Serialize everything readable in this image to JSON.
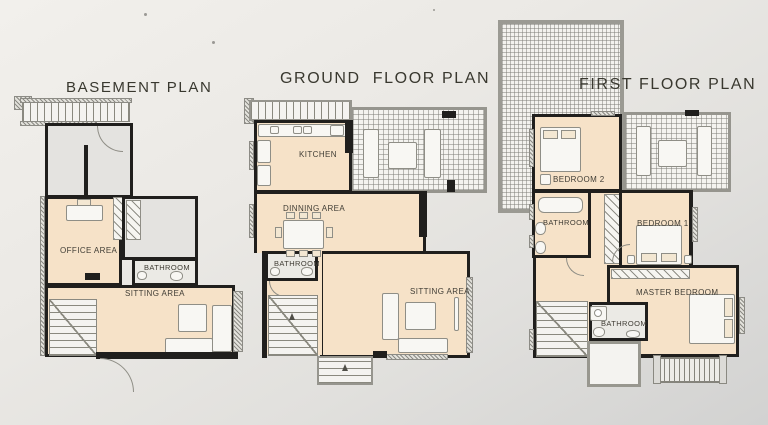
{
  "plans": [
    {
      "id": "basement",
      "title": "BASEMENT PLAN",
      "rooms": [
        {
          "label": "OFFICE AREA"
        },
        {
          "label": "BATHROOM"
        },
        {
          "label": "SITTING AREA"
        }
      ]
    },
    {
      "id": "ground-floor",
      "title": "GROUND  FLOOR PLAN",
      "rooms": [
        {
          "label": "KITCHEN"
        },
        {
          "label": "DINNING AREA"
        },
        {
          "label": "BATHROOM"
        },
        {
          "label": "SITTING AREA"
        }
      ]
    },
    {
      "id": "first-floor",
      "title": "FIRST FLOOR PLAN",
      "rooms": [
        {
          "label": "BEDROOM 2"
        },
        {
          "label": "BATHROOM"
        },
        {
          "label": "BEDROOM 1"
        },
        {
          "label": "MASTER BEDROOM"
        },
        {
          "label": "BATHROOM"
        }
      ]
    }
  ],
  "colors": {
    "wall": "#201f1d",
    "floor_beige": "#f6e2c8",
    "floor_gray": "#e4e3e0",
    "tile_floor": "#f3f2ee",
    "paper_light": "#f1efeb",
    "paper_dark": "#d3d3d2",
    "title_text": "#39382f",
    "label_text": "#403d35"
  }
}
